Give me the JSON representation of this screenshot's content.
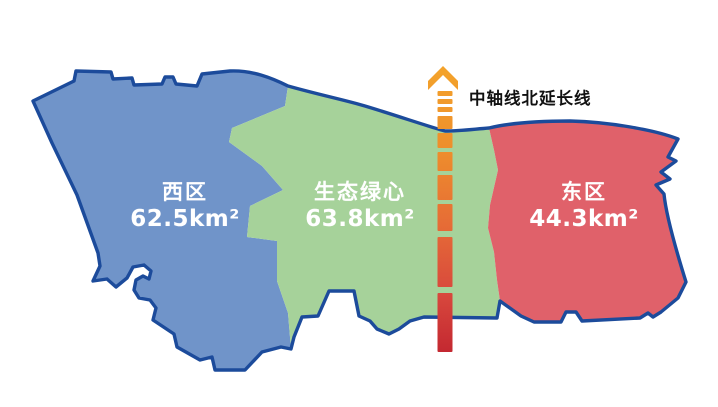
{
  "map": {
    "background_color": "#FFFFFF",
    "outline_color": "#1C4B9B",
    "regions": [
      {
        "name": "西区",
        "area": "62.5km²",
        "color": "#7094C9",
        "text_color": "#FFFFFF"
      },
      {
        "name": "生态绿心",
        "area": "63.8km²",
        "color": "#A6D29A",
        "text_color": "#FFFFFF"
      },
      {
        "name": "东区",
        "area": "44.3km²",
        "color": "#E0616A",
        "text_color": "#FFFFFF"
      }
    ],
    "axis_line": {
      "label": "中轴线北延长线",
      "label_color": "#111111",
      "gradient": [
        "#F4A52B",
        "#EE8E2C",
        "#E66C36",
        "#D8483D",
        "#C1242F"
      ]
    }
  }
}
